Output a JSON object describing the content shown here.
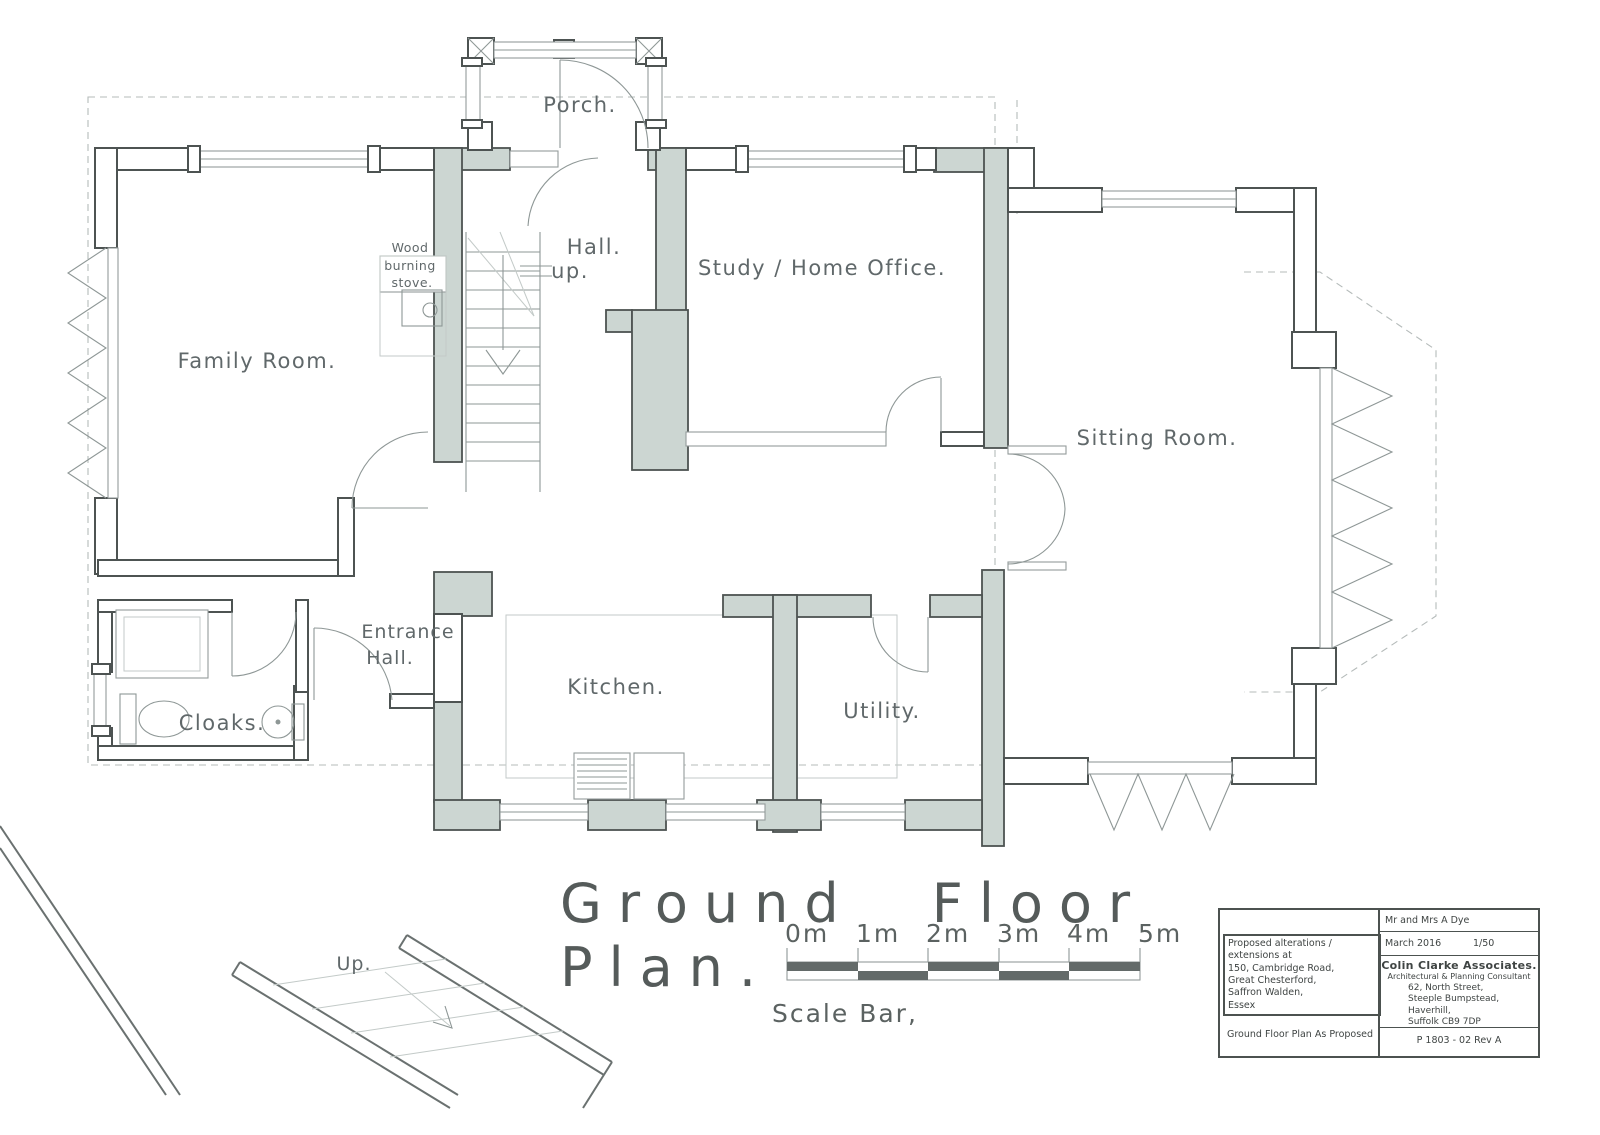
{
  "rooms": {
    "porch": "Porch.",
    "family_room": "Family  Room.",
    "hall": "Hall.",
    "hall_up": "up.",
    "study": "Study / Home Office.",
    "sitting_room": "Sitting  Room.",
    "entrance_line1": "Entrance",
    "entrance_line2": "Hall.",
    "cloaks": "Cloaks.",
    "kitchen": "Kitchen.",
    "utility": "Utility.",
    "stove_line1": "Wood",
    "stove_line2": "burning",
    "stove_line3": "stove.",
    "external_up": "Up."
  },
  "titles": {
    "main_line1": "Ground  Floor",
    "main_line2": "Plan.",
    "scale_caption": "Scale  Bar,"
  },
  "scale": {
    "ticks": [
      "0m",
      "1m",
      "2m",
      "3m",
      "4m",
      "5m"
    ]
  },
  "title_block": {
    "client": "Mr and Mrs  A Dye",
    "date": "March 2016",
    "scale": "1/50",
    "firm": "Colin Clarke Associates.",
    "firm_subtitle": "Architectural & Planning Consultant",
    "address_line1": "62, North Street,",
    "address_line2": "Steeple Bumpstead, Haverhill,",
    "address_line3": "Suffolk   CB9 7DP",
    "project_line1": "Proposed alterations / extensions at",
    "project_line2": "150, Cambridge Road,",
    "project_line3": "Great Chesterford,",
    "project_line4": "Saffron Walden,",
    "project_line5": "Essex",
    "drawing_title": "Ground Floor Plan As Proposed",
    "drawing_number": "P 1803 - 02  Rev A"
  },
  "colors": {
    "new_wall_fill": "#ccd6d2",
    "wall_stroke": "#4d5352",
    "thin_line": "#8e9796",
    "text": "#60686a",
    "scale_dark": "#636a69"
  }
}
